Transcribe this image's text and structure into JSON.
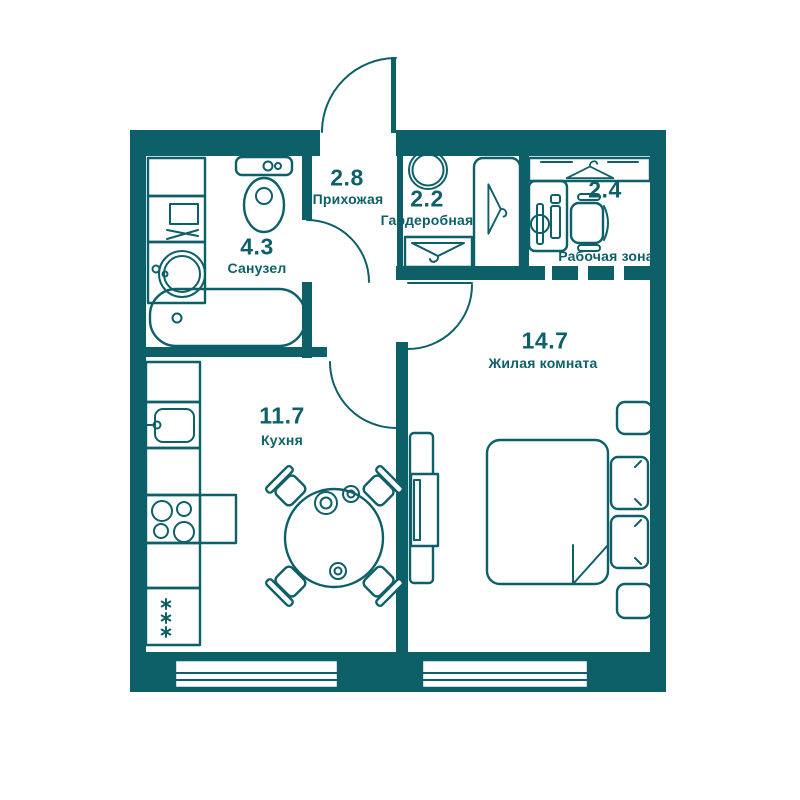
{
  "plan": {
    "colors": {
      "line": "#0d5f68",
      "background": "#ffffff"
    },
    "rooms": [
      {
        "id": "bathroom",
        "area": "4.3",
        "name": "Санузел"
      },
      {
        "id": "hallway",
        "area": "2.8",
        "name": "Прихожая"
      },
      {
        "id": "wardrobe",
        "area": "2.2",
        "name": "Гардеробная"
      },
      {
        "id": "work-zone",
        "area": "2.4",
        "name": "Рабочая зона"
      },
      {
        "id": "living-room",
        "area": "14.7",
        "name": "Жилая комната"
      },
      {
        "id": "kitchen",
        "area": "11.7",
        "name": "Кухня"
      }
    ],
    "icons": [
      "bathtub-icon",
      "toilet-icon",
      "washbasin-icon",
      "washing-machine-icon",
      "kitchen-sink-icon",
      "stove-icon",
      "fridge-snowflake-icon",
      "dining-table-icon",
      "dining-chair-icon",
      "clothes-hanger-icon",
      "pouf-icon",
      "desk-icon",
      "office-chair-icon",
      "bed-icon",
      "pillow-icon",
      "nightstand-icon",
      "tv-icon",
      "window-icon",
      "door-arc-icon"
    ]
  }
}
